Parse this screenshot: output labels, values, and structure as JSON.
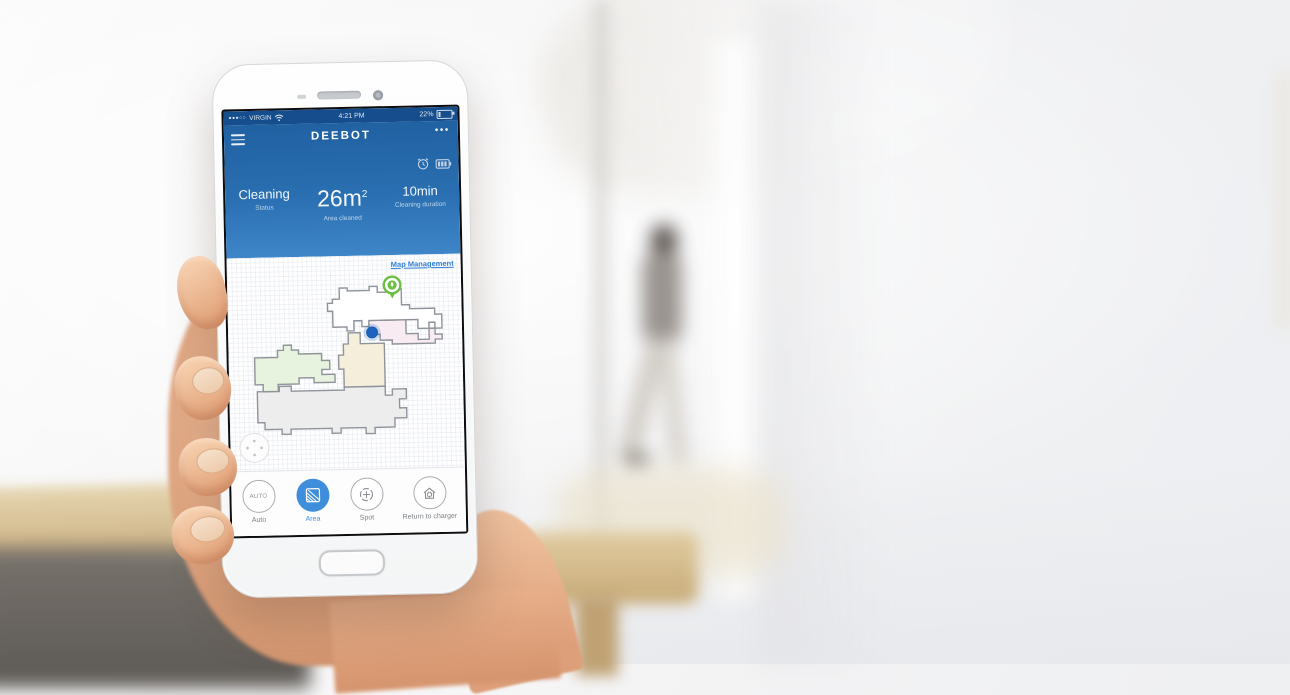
{
  "status_bar": {
    "signal": "●●●○○",
    "carrier": "VIRGIN",
    "time": "4:21 PM",
    "battery_percent": "22%"
  },
  "nav": {
    "title": "DEEBOT",
    "more_glyph": "•••"
  },
  "stats": {
    "status_value": "Cleaning",
    "status_label": "Status",
    "area_value": "26m",
    "area_sup": "2",
    "area_label": "Area cleaned",
    "duration_value": "10min",
    "duration_label": "Cleaning duration"
  },
  "map": {
    "management_link": "Map Management",
    "markers": [
      "charging-dock-pin",
      "robot-position-dot"
    ],
    "room_fills": [
      "#ffffff",
      "#f8ebf2",
      "#f5eedb",
      "#e7f3df",
      "#ededee"
    ]
  },
  "controls": {
    "auto": {
      "label": "Auto",
      "badge": "AUTO"
    },
    "area": {
      "label": "Area"
    },
    "spot": {
      "label": "Spot"
    },
    "return": {
      "label": "Return to charger"
    }
  },
  "colors": {
    "header_top": "#2061a2",
    "header_bottom": "#3e86c8",
    "statusbar": "#164d8c",
    "accent_blue": "#3f8edb",
    "link_blue": "#2f7fd6",
    "pin_green": "#6cbe44",
    "robot_blue": "#1e63be",
    "wall_stroke": "#8f939a"
  }
}
